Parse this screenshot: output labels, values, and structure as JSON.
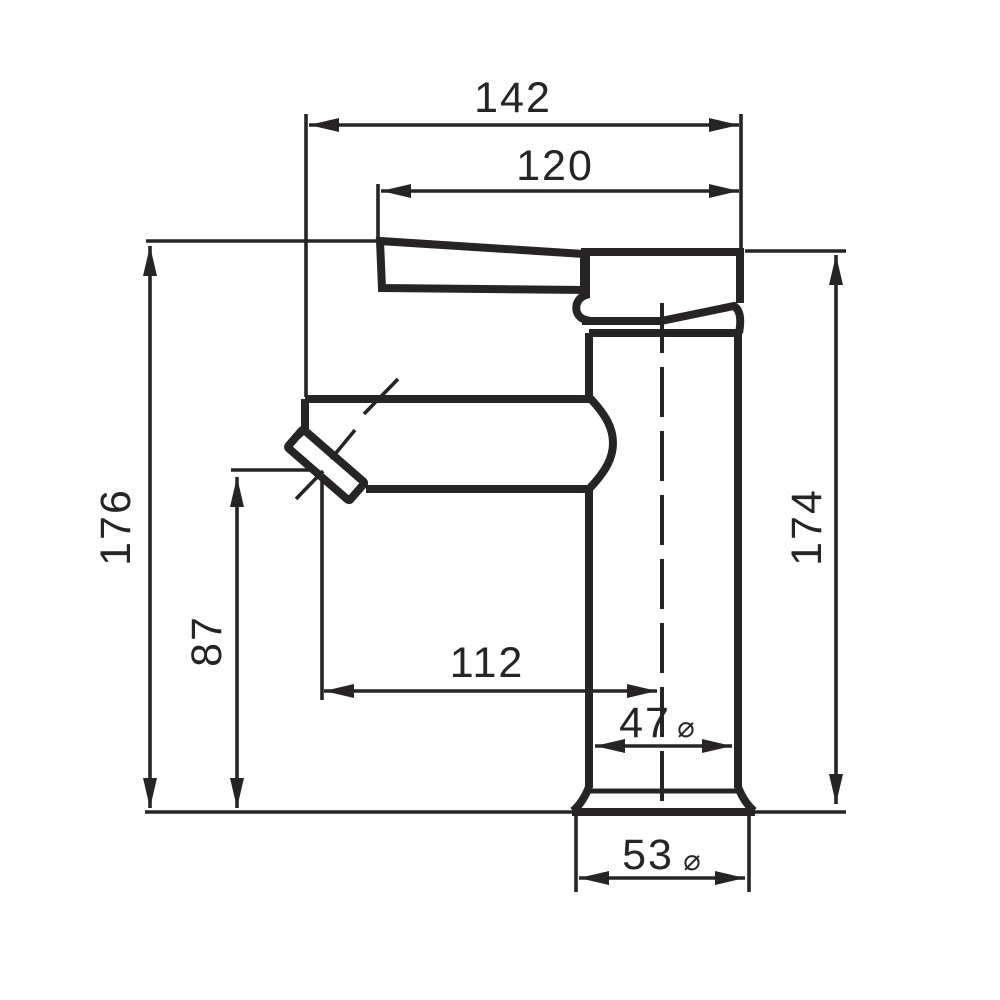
{
  "drawing": {
    "background": "#ffffff",
    "ink": "#272425",
    "diameter_symbol": "⌀",
    "dims": {
      "overall_reach": "142",
      "handle_reach": "120",
      "overall_height": "176",
      "spout_outlet_height": "87",
      "spout_reach_to_axis": "112",
      "body_diameter": "47",
      "base_diameter": "53",
      "body_height": "174"
    }
  }
}
